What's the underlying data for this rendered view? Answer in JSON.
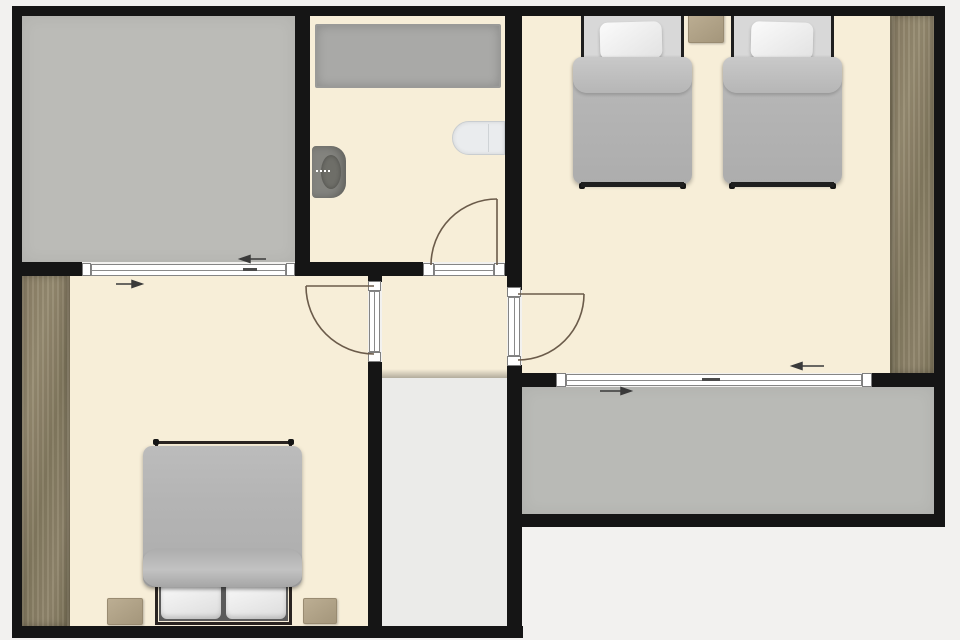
{
  "plan_type": "residential-floor-plan-top-view",
  "colors": {
    "background": "#f2f1ef",
    "wall": "#151515",
    "floor": "#f7eed8",
    "terrace": "#bbbbb7",
    "balcony": "#b9bab6",
    "shower_tray": "#a9a9a7",
    "stairs": "#ebebe9",
    "wardrobe_wood": "#8c8167",
    "nightstand_wood": "#b2a489",
    "duvet_gray": "#b6b6b6",
    "pillow_white": "#f2f2f2",
    "mattress_light": "#d8d8d8",
    "bed_frame": "#1f1f1f",
    "toilet_gray": "#83837e",
    "sink_white": "#eaecee",
    "door_swing_line": "#6b5b4a",
    "arrow": "#3a3a3a",
    "opening_white": "#ffffff"
  },
  "stairs": {
    "steps": 10
  },
  "rooms": [
    {
      "id": "terrace",
      "kind": "roof-terrace",
      "fill_key": "terrace"
    },
    {
      "id": "bathroom",
      "kind": "bathroom",
      "fill_key": "floor"
    },
    {
      "id": "bedroom-twin",
      "kind": "bedroom",
      "fill_key": "floor"
    },
    {
      "id": "hallway",
      "kind": "landing",
      "fill_key": "floor"
    },
    {
      "id": "bedroom-double",
      "kind": "bedroom",
      "fill_key": "floor"
    },
    {
      "id": "staircase",
      "kind": "stairs",
      "fill_key": "stairs"
    },
    {
      "id": "balcony",
      "kind": "balcony",
      "fill_key": "balcony"
    }
  ],
  "furniture": [
    {
      "item": "shower-tray",
      "room": "bathroom",
      "count": 1
    },
    {
      "item": "toilet",
      "room": "bathroom",
      "count": 1
    },
    {
      "item": "washbasin",
      "room": "bathroom",
      "count": 1
    },
    {
      "item": "single-bed",
      "room": "bedroom-twin",
      "count": 2
    },
    {
      "item": "nightstand",
      "room": "bedroom-twin",
      "count": 1
    },
    {
      "item": "wardrobe",
      "room": "bedroom-twin",
      "count": 1
    },
    {
      "item": "double-bed",
      "room": "bedroom-double",
      "count": 1
    },
    {
      "item": "nightstand",
      "room": "bedroom-double",
      "count": 2
    },
    {
      "item": "wardrobe",
      "room": "bedroom-double",
      "count": 1
    }
  ],
  "doors": [
    {
      "between": [
        "hallway",
        "bathroom"
      ],
      "swing": "into-bathroom"
    },
    {
      "between": [
        "hallway",
        "bedroom-double"
      ],
      "swing": "into-bedroom"
    },
    {
      "between": [
        "hallway",
        "bedroom-twin"
      ],
      "swing": "into-bedroom"
    }
  ],
  "sliding_doors": [
    {
      "between": [
        "bedroom-double",
        "terrace"
      ],
      "direction_arrows": [
        "left",
        "right"
      ]
    },
    {
      "between": [
        "bedroom-twin",
        "balcony"
      ],
      "direction_arrows": [
        "left",
        "right"
      ]
    }
  ]
}
